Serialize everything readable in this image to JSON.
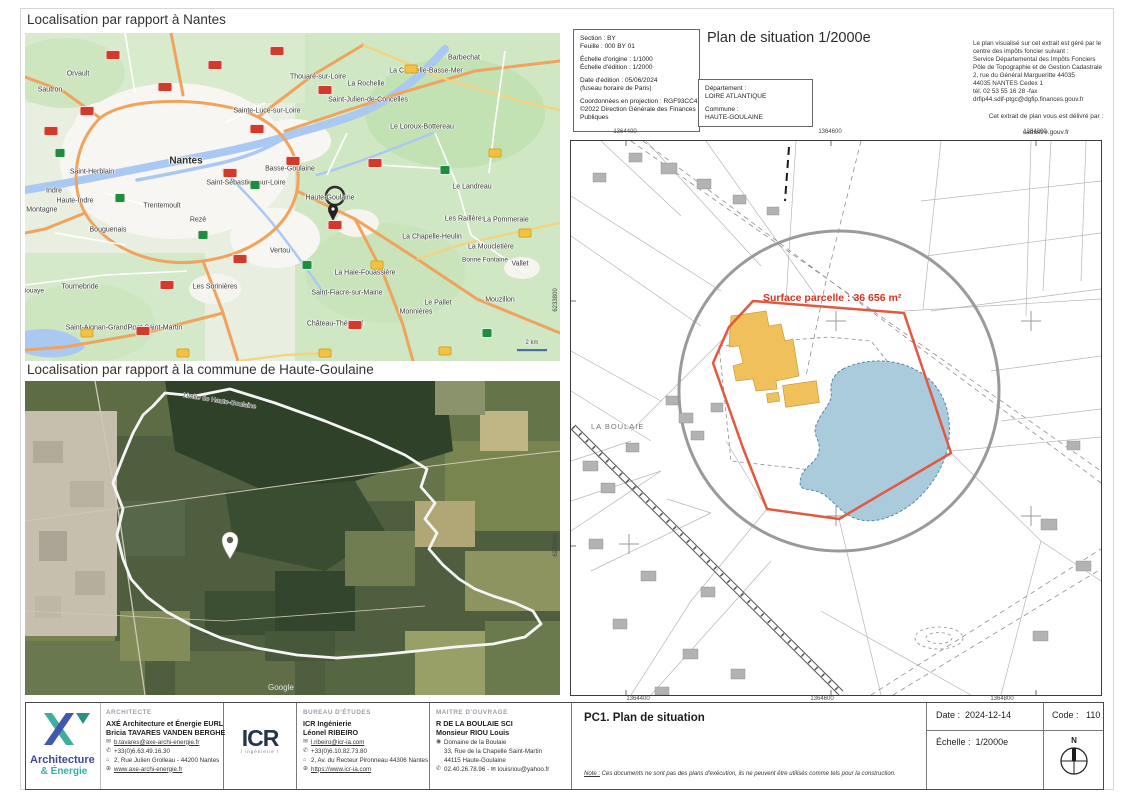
{
  "titles": {
    "nantes": "Localisation par rapport à Nantes",
    "commune": "Localisation par rapport à la commune de Haute-Goulaine"
  },
  "map_nantes": {
    "labels": [
      {
        "t": "Orvault",
        "x": 53,
        "y": 41
      },
      {
        "t": "Sautron",
        "x": 25,
        "y": 57
      },
      {
        "t": "Thouaré-sur-Loire",
        "x": 293,
        "y": 44
      },
      {
        "t": "La Rochelle",
        "x": 341,
        "y": 51
      },
      {
        "t": "La Chapelle-Basse-Mer",
        "x": 401,
        "y": 38
      },
      {
        "t": "Barbechat",
        "x": 439,
        "y": 25
      },
      {
        "t": "Saint-Julien-de-Concelles",
        "x": 343,
        "y": 67
      },
      {
        "t": "Sainte-Luce-sur-Loire",
        "x": 242,
        "y": 78
      },
      {
        "t": "Le Loroux-Bottereau",
        "x": 397,
        "y": 94
      },
      {
        "t": "Saint-Herblain",
        "x": 67,
        "y": 139
      },
      {
        "t": "Nantes",
        "x": 161,
        "y": 128,
        "s": 10,
        "b": 1
      },
      {
        "t": "Basse-Goulaine",
        "x": 265,
        "y": 136
      },
      {
        "t": "Saint-Sébastien-sur-Loire",
        "x": 221,
        "y": 150
      },
      {
        "t": "Indre",
        "x": 29,
        "y": 158
      },
      {
        "t": "Haute-Indre",
        "x": 50,
        "y": 168
      },
      {
        "t": "La Montagne",
        "x": 12,
        "y": 177
      },
      {
        "t": "Trentemoult",
        "x": 137,
        "y": 173
      },
      {
        "t": "Rezé",
        "x": 173,
        "y": 187
      },
      {
        "t": "Bouguenais",
        "x": 83,
        "y": 197
      },
      {
        "t": "Haute-Goulaine",
        "x": 305,
        "y": 165
      },
      {
        "t": "Le Landreau",
        "x": 447,
        "y": 154
      },
      {
        "t": "Les Raillères",
        "x": 440,
        "y": 186
      },
      {
        "t": "La Pommeraie",
        "x": 481,
        "y": 187
      },
      {
        "t": "La Chapelle-Heulin",
        "x": 407,
        "y": 204
      },
      {
        "t": "La Moucletière",
        "x": 466,
        "y": 214
      },
      {
        "t": "Vertou",
        "x": 255,
        "y": 218
      },
      {
        "t": "Bonne Fontaine",
        "x": 460,
        "y": 227,
        "s": 6.5
      },
      {
        "t": "Vallet",
        "x": 495,
        "y": 231
      },
      {
        "t": "La Haie-Fouassière",
        "x": 340,
        "y": 240
      },
      {
        "t": "Les Sorinières",
        "x": 190,
        "y": 254
      },
      {
        "t": "Saint-Fiacre-sur-Maine",
        "x": 322,
        "y": 260
      },
      {
        "t": "Le Pallet",
        "x": 413,
        "y": 270
      },
      {
        "t": "Mouzillon",
        "x": 475,
        "y": 267
      },
      {
        "t": "Monnières",
        "x": 391,
        "y": 279
      },
      {
        "t": "Château-Thébaud",
        "x": 310,
        "y": 291
      },
      {
        "t": "Tournebride",
        "x": 55,
        "y": 254
      },
      {
        "t": "Saint-Aignan-Grandlieu",
        "x": 77,
        "y": 295
      },
      {
        "t": "Pont-Saint-Martin",
        "x": 130,
        "y": 295
      },
      {
        "t": "Bouaye",
        "x": 8,
        "y": 258,
        "s": 6.5
      },
      {
        "t": "2 km",
        "x": 507,
        "y": 310,
        "s": 6
      }
    ],
    "shields": [
      {
        "x": 88,
        "y": 22,
        "c": "r"
      },
      {
        "x": 140,
        "y": 54,
        "c": "r"
      },
      {
        "x": 62,
        "y": 78,
        "c": "r"
      },
      {
        "x": 26,
        "y": 98,
        "c": "r"
      },
      {
        "x": 190,
        "y": 32,
        "c": "r"
      },
      {
        "x": 252,
        "y": 18,
        "c": "r"
      },
      {
        "x": 300,
        "y": 57,
        "c": "r"
      },
      {
        "x": 232,
        "y": 96,
        "c": "r"
      },
      {
        "x": 205,
        "y": 140,
        "c": "r"
      },
      {
        "x": 268,
        "y": 128,
        "c": "r"
      },
      {
        "x": 310,
        "y": 192,
        "c": "r"
      },
      {
        "x": 215,
        "y": 226,
        "c": "r"
      },
      {
        "x": 142,
        "y": 252,
        "c": "r"
      },
      {
        "x": 118,
        "y": 298,
        "c": "r"
      },
      {
        "x": 330,
        "y": 292,
        "c": "r"
      },
      {
        "x": 350,
        "y": 130,
        "c": "r"
      },
      {
        "x": 35,
        "y": 120,
        "c": "g"
      },
      {
        "x": 230,
        "y": 152,
        "c": "g"
      },
      {
        "x": 95,
        "y": 165,
        "c": "g"
      },
      {
        "x": 282,
        "y": 232,
        "c": "g"
      },
      {
        "x": 420,
        "y": 137,
        "c": "g"
      },
      {
        "x": 462,
        "y": 300,
        "c": "g"
      },
      {
        "x": 178,
        "y": 202,
        "c": "g"
      },
      {
        "x": 386,
        "y": 36,
        "c": "y"
      },
      {
        "x": 470,
        "y": 120,
        "c": "y"
      },
      {
        "x": 352,
        "y": 232,
        "c": "y"
      },
      {
        "x": 300,
        "y": 320,
        "c": "y"
      },
      {
        "x": 62,
        "y": 300,
        "c": "y"
      },
      {
        "x": 500,
        "y": 200,
        "c": "y"
      },
      {
        "x": 420,
        "y": 318,
        "c": "y"
      },
      {
        "x": 158,
        "y": 320,
        "c": "y"
      }
    ]
  },
  "map_commune": {
    "boundary_label": "Limite de Haute-Goulaine",
    "attribution": "Google"
  },
  "cadastre_header": {
    "info_lines": [
      "Section : BY",
      "Feuille : 000 BY 01",
      "",
      "Échelle d'origine : 1/1000",
      "Échelle d'édition : 1/2000",
      "",
      "Date d'édition : 05/06/2024",
      "(fuseau horaire de Paris)",
      "",
      "Coordonnées en projection : RGF93CC47",
      "©2022 Direction Générale des Finances",
      "Publiques"
    ],
    "plan_title": "Plan de situation 1/2000e",
    "dept_lines": [
      "Département :",
      "LOIRE ATLANTIQUE",
      "",
      "Commune :",
      "HAUTE-GOULAINE"
    ],
    "notice_lines": [
      "Le plan visualisé sur cet extrait est géré par le",
      "centre des impôts foncier suivant :",
      "Service Départemental des Impôts Fonciers",
      "Pôle de Topographie et de Gestion Cadastrale",
      "2, rue du Général Margueritte 44035",
      "44035 NANTES Cedex 1",
      "tél. 02 53 55 16 28 -fax",
      "drfip44.sdif-ptgc@dgfip.finances.gouv.fr"
    ],
    "delivery_line": "Cet extrait de plan vous est délivré par :",
    "delivery_site": "cadastre.gouv.fr"
  },
  "cadastre_map": {
    "surface_label": "Surface parcelle : 36 656 m²",
    "place_label": "LA BOULAIE",
    "coords_top": [
      "1364400",
      "1364600",
      "1364800"
    ],
    "coords_bottom": [
      "1364400",
      "1364600",
      "1364800"
    ],
    "coords_left": [
      "6233800",
      "6233600"
    ],
    "colors": {
      "parcel_outline": "#e2593f",
      "buildings": "#f0c05a",
      "water": "#a9cbdc",
      "circle": "#9a9a9a",
      "surface_text": "#e0301e"
    }
  },
  "titleblock": {
    "architecte": {
      "heading": "ARCHITECTE",
      "company": "AXÉ Architecture et Énergie EURL",
      "contact_name": "Bricia TAVARES VANDEN BERGHE",
      "contacts": [
        {
          "i": "✉",
          "t": "b.tavares@axe-archi-energie.fr",
          "u": 1
        },
        {
          "i": "✆",
          "t": "+33(0)6.63.49.16.30"
        },
        {
          "i": "⌂",
          "t": "2, Rue Julien Grolleau - 44200 Nantes"
        },
        {
          "i": "⊕",
          "t": "www.axe-archi-energie.fr",
          "u": 1
        }
      ]
    },
    "bureau": {
      "heading": "BUREAU D'ÉTUDES",
      "company": "ICR Ingénierie",
      "contact_name": "Léonel RIBEIRO",
      "contacts": [
        {
          "i": "✉",
          "t": "l.ribeiro@icr-ia.com",
          "u": 1
        },
        {
          "i": "✆",
          "t": "+33(0)6.10.82.73.80"
        },
        {
          "i": "⌂",
          "t": "2, Av. du Recteur Pironneau 44306 Nantes"
        },
        {
          "i": "⊕",
          "t": "https://www.icr-ia.com",
          "u": 1
        }
      ]
    },
    "maitre": {
      "heading": "MAITRE D'OUVRAGE",
      "company": "R DE LA BOULAIE SCI",
      "contact_name": "Monsieur RIOU Louis",
      "contacts": [
        {
          "i": "◉",
          "t": "Domaine de la Boulaie"
        },
        {
          "i": "",
          "t": "33, Rue de la Chapelle Saint-Martin"
        },
        {
          "i": "",
          "t": "44115 Haute-Goulaine"
        },
        {
          "i": "✆",
          "t": "02.40.26.78.96 -  ✉ louisriou@yahoo.fr"
        }
      ]
    },
    "logo_axe": {
      "line1": "Architecture",
      "line2": "& Énergie"
    },
    "logo_icr": {
      "text": "ICR",
      "sub": "/ ingénierie /"
    },
    "doc_title": "PC1. Plan de situation",
    "note_label": "Note :",
    "note_text": " Ces documents ne sont pas des plans d'exécution, ils ne peuvent être utilisés comme tels pour la construction.",
    "date_label": "Date :",
    "date_value": "2024-12-14",
    "code_label": "Code :",
    "code_value": "110",
    "scale_label": "Échelle :",
    "scale_value": "1/2000e",
    "north_label": "N"
  }
}
